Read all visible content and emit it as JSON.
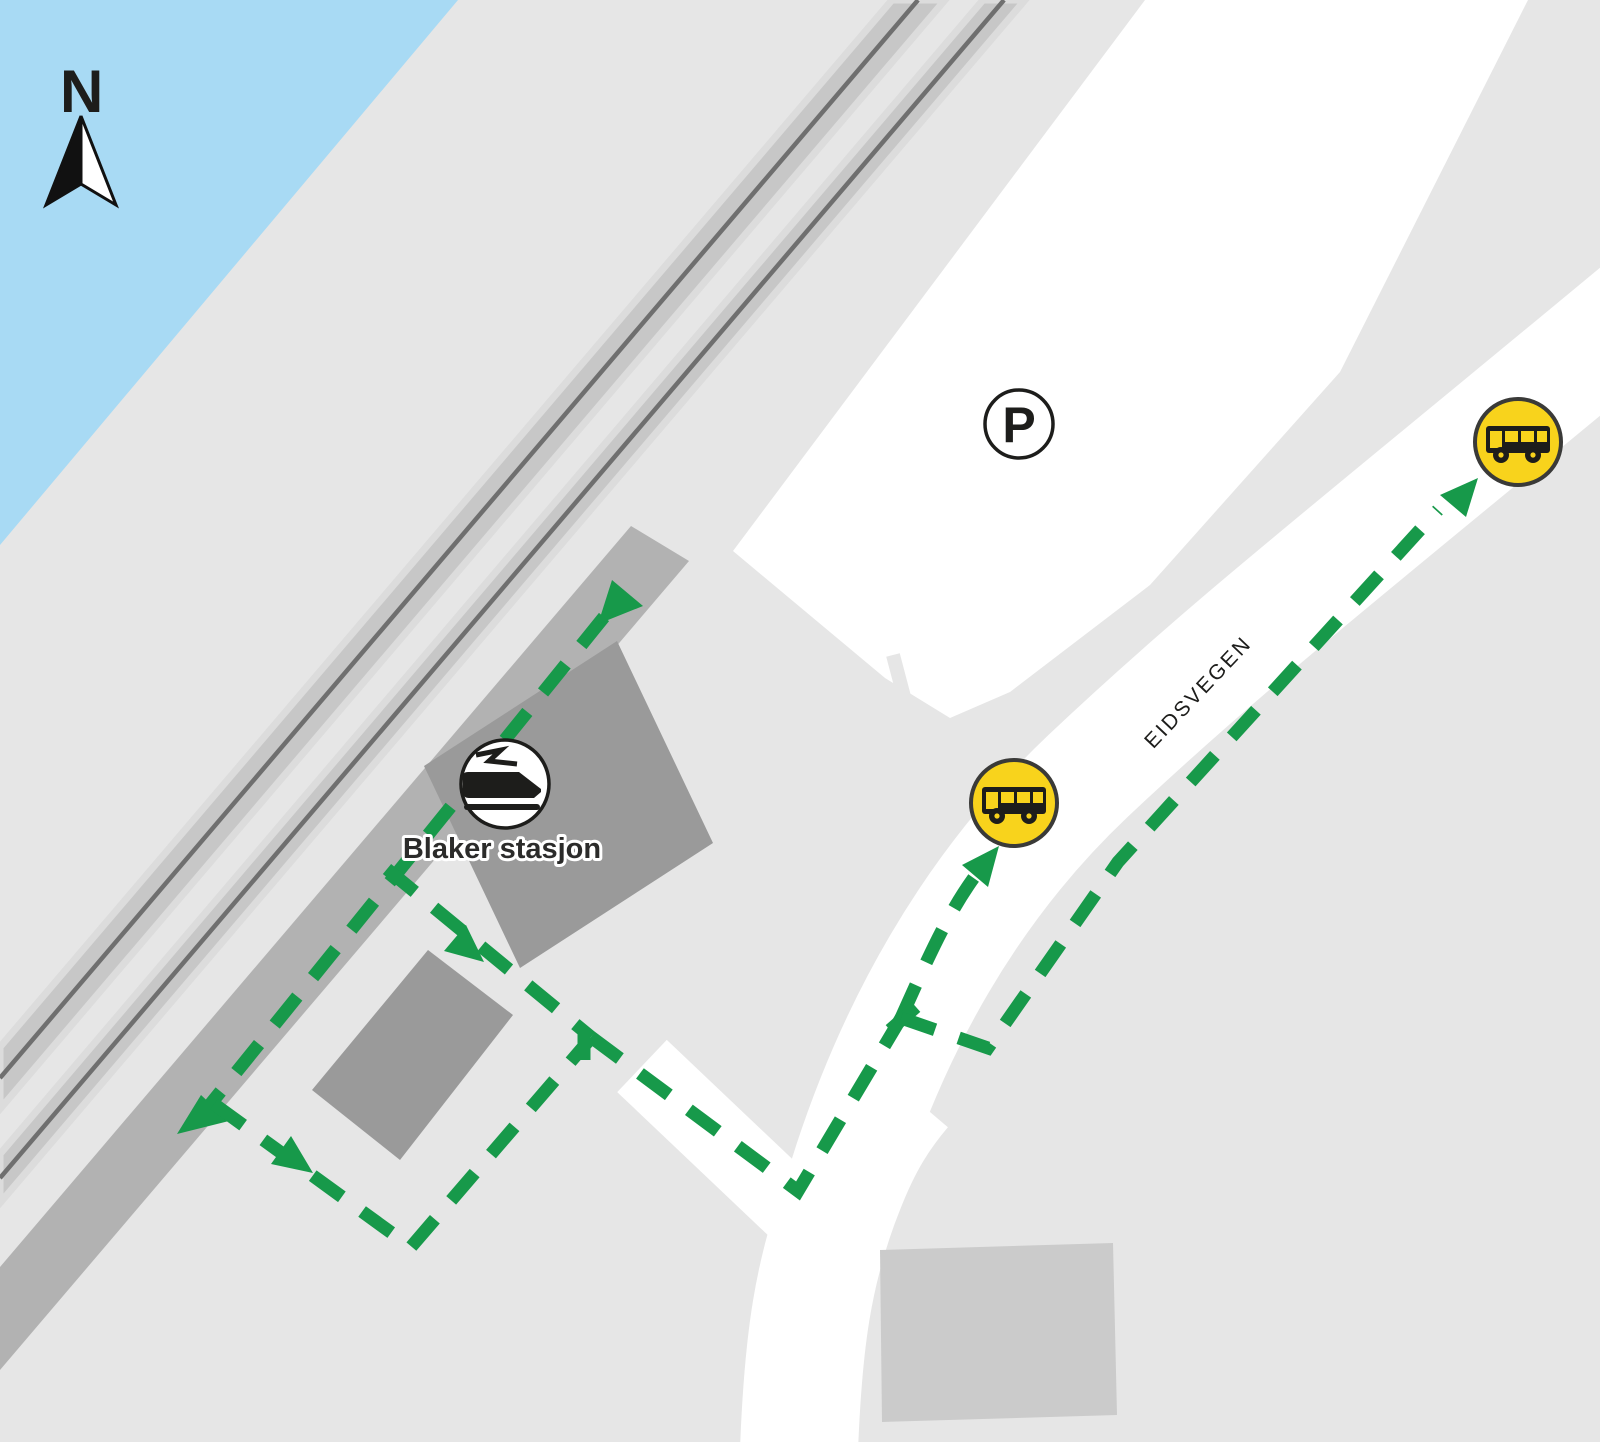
{
  "map": {
    "north_indicator": {
      "label": "N",
      "icon": "compass-needle-icon"
    },
    "station": {
      "name": "Blaker stasjon",
      "icon": "train-icon"
    },
    "parking": {
      "label": "P",
      "icon": "parking-icon"
    },
    "street": {
      "name": "EIDSVEGEN"
    },
    "bus_stops": [
      {
        "id": "bus-stop-west",
        "icon": "bus-icon"
      },
      {
        "id": "bus-stop-northeast",
        "icon": "bus-icon"
      }
    ],
    "walking_route": {
      "style": "dashed",
      "color": "#17994a"
    },
    "colors": {
      "water": "#a8daf4",
      "background": "#e6e6e6",
      "surface_white": "#ffffff",
      "platform": "#b2b2b2",
      "building_dark": "#9a9a9a",
      "building_light": "#cbcbcb",
      "track_fill": "#c7c7c7",
      "track_edge": "#dcdcdc",
      "track_rail": "#6f6f6f",
      "route_green": "#17994a",
      "bus_yellow": "#f8d31c",
      "icon_dark": "#1d1d1b"
    }
  }
}
